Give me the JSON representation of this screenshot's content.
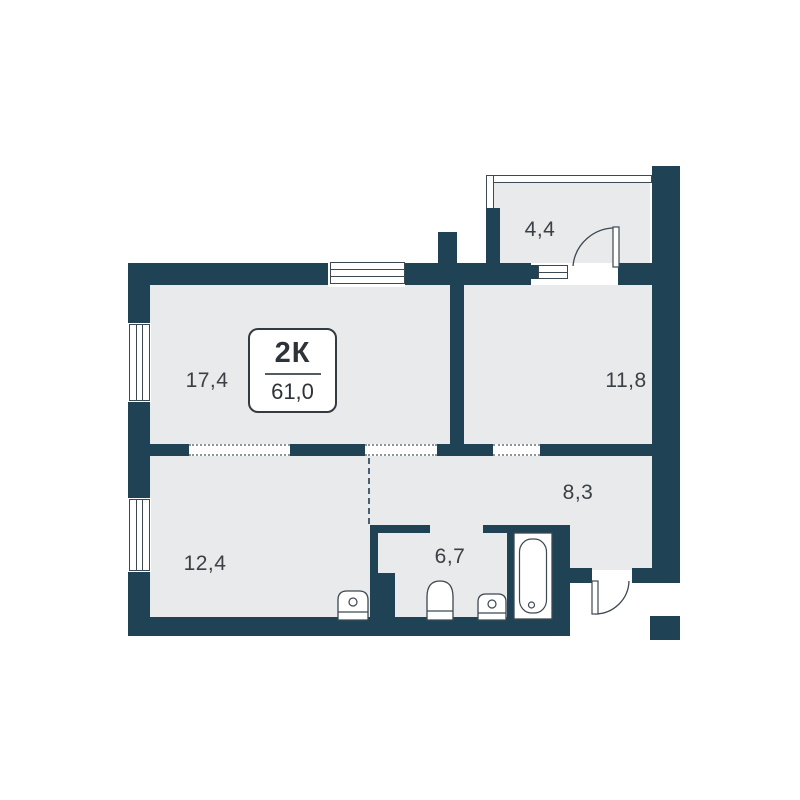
{
  "plan": {
    "type_label": "2К",
    "total_area": "61,0",
    "rooms": [
      {
        "name": "living-room",
        "area": "17,4"
      },
      {
        "name": "bedroom",
        "area": "11,8"
      },
      {
        "name": "kitchen-living",
        "area": "12,4"
      },
      {
        "name": "hallway",
        "area": "8,3"
      },
      {
        "name": "bathroom",
        "area": "6,7"
      },
      {
        "name": "balcony",
        "area": "4,4"
      }
    ],
    "fixtures": [
      "bathtub",
      "toilet",
      "sink",
      "kitchen-sink"
    ],
    "colors": {
      "wall": "#1f4254",
      "room-fill": "#e9eaeb",
      "background": "#ffffff",
      "line": "#3c4852",
      "text": "#3a4045"
    }
  }
}
